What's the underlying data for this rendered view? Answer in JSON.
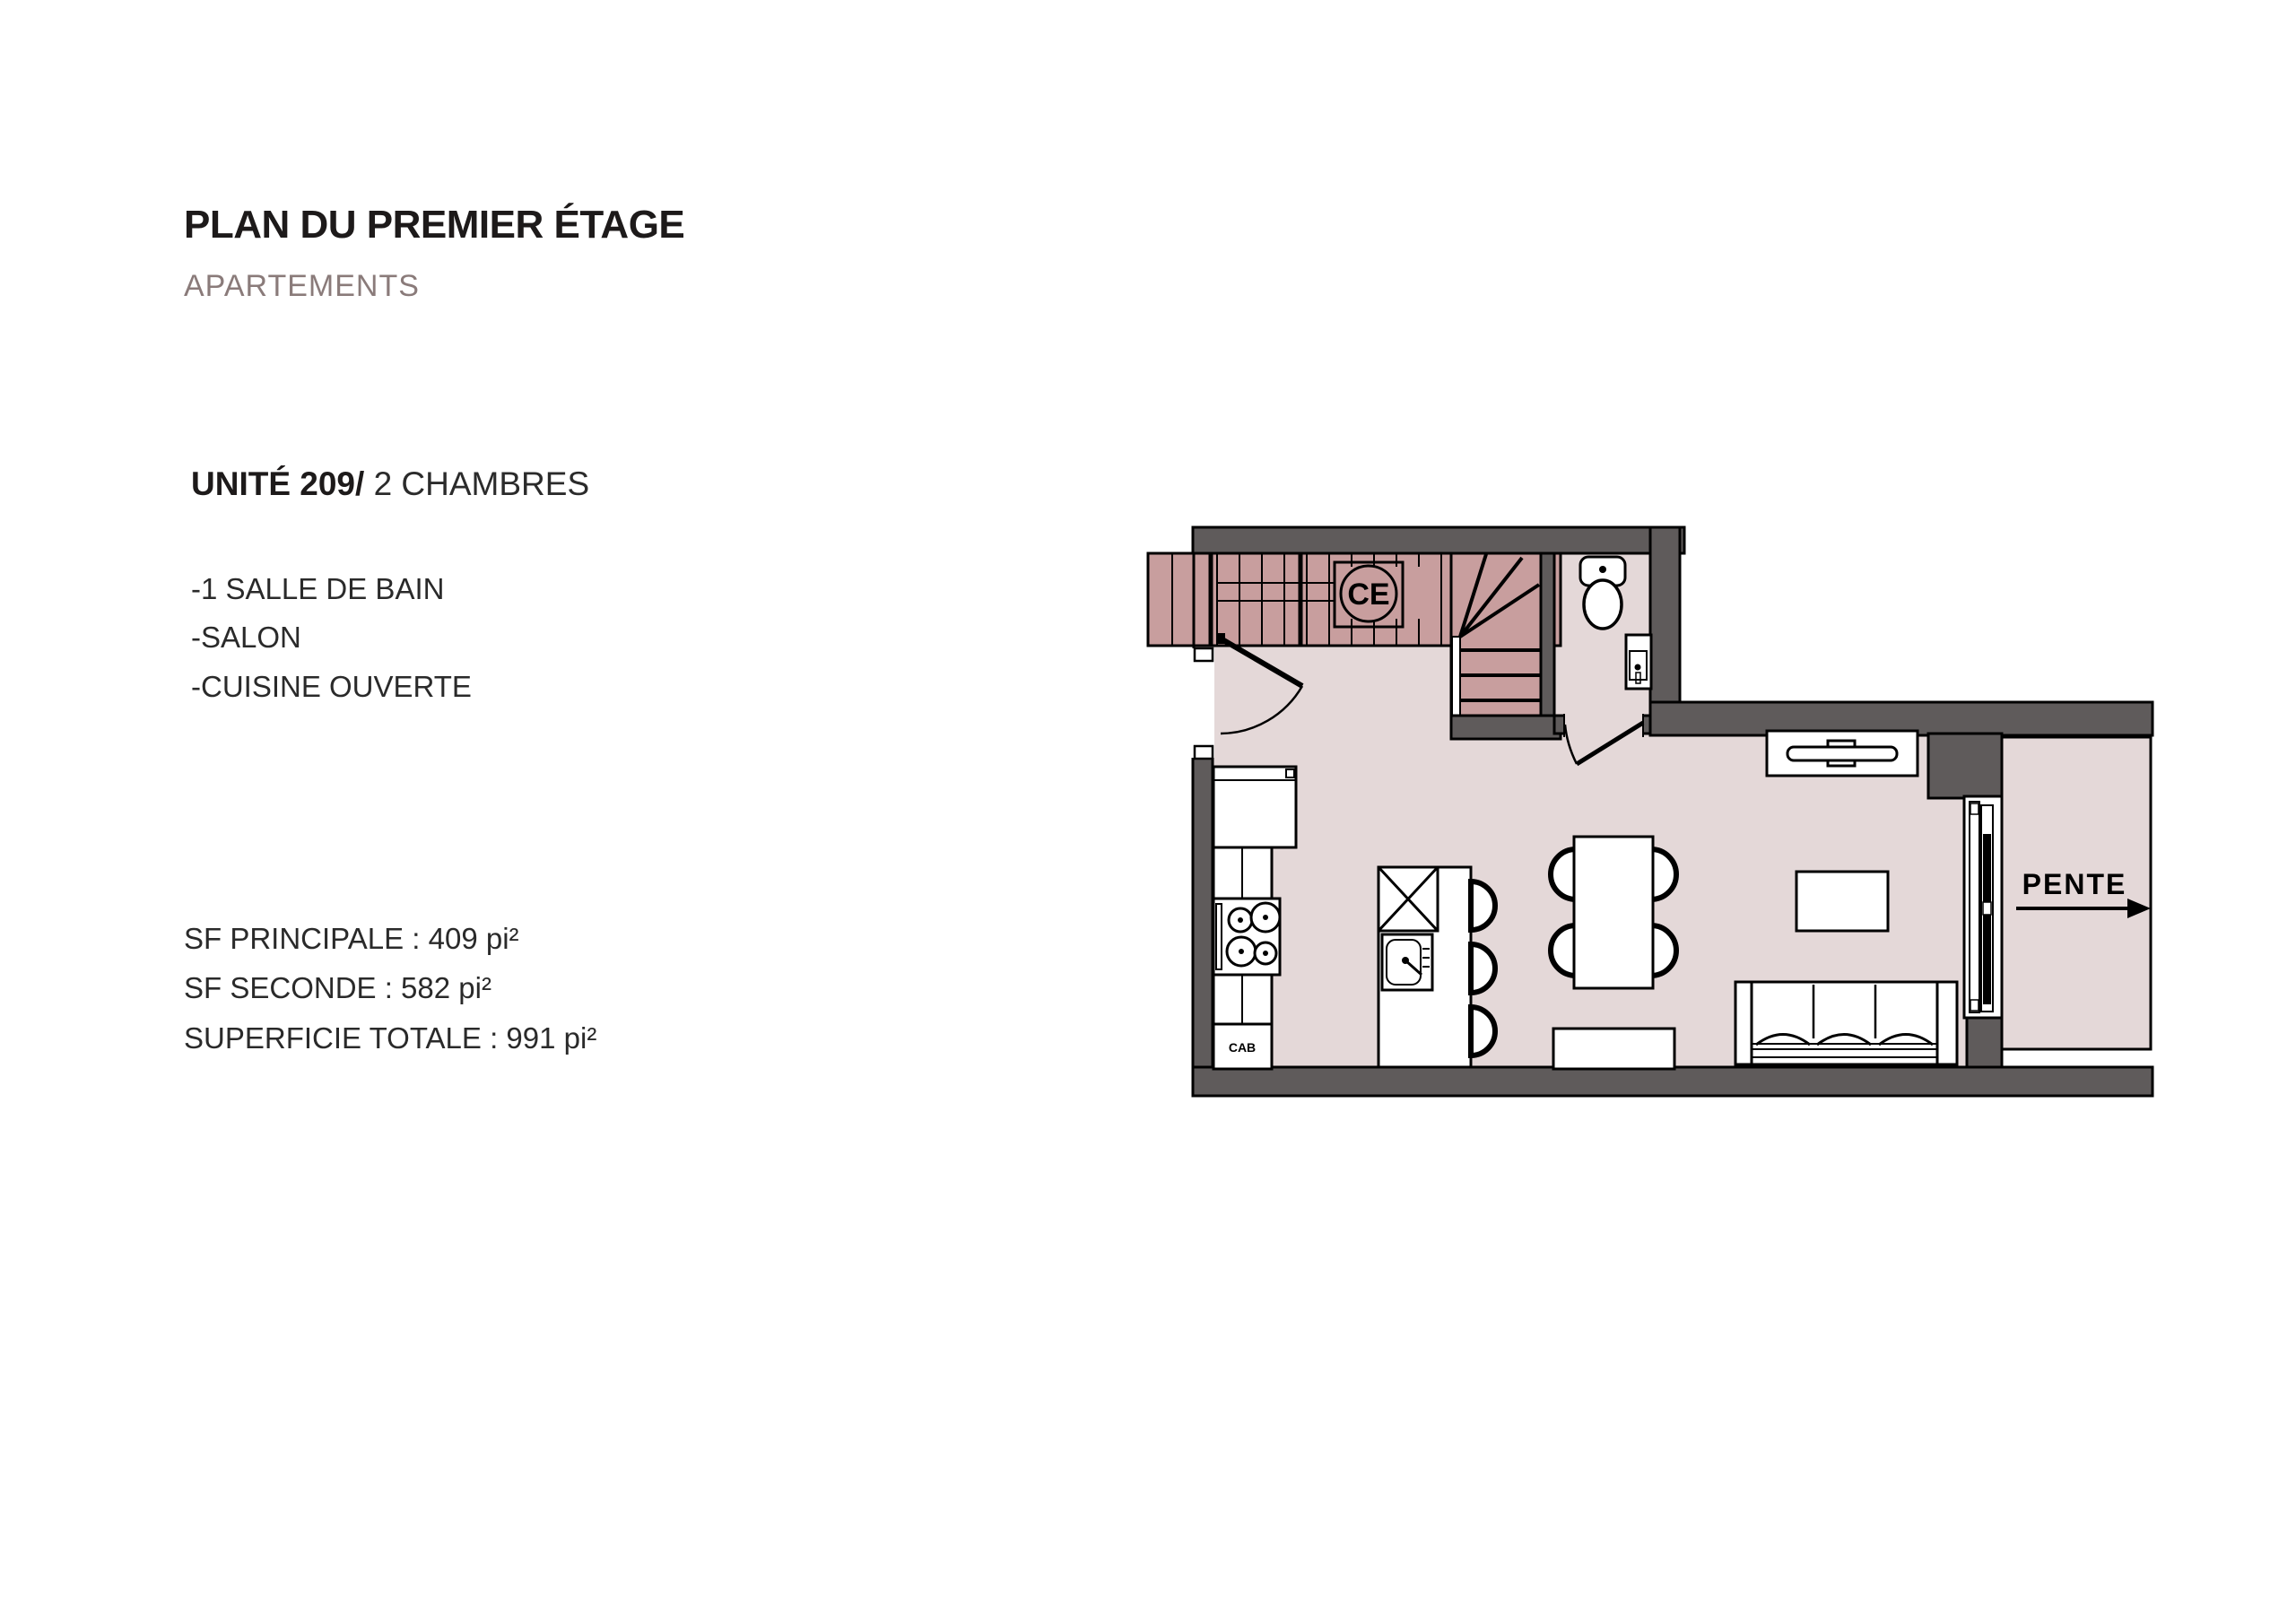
{
  "page": {
    "title": "PLAN DU PREMIER ÉTAGE",
    "subtitle": "APARTEMENTS"
  },
  "unit": {
    "number_label": "UNITÉ 209/",
    "type_label": " 2 CHAMBRES",
    "features": [
      "-1 SALLE DE BAIN",
      "-SALON",
      "-CUISINE OUVERTE"
    ],
    "areas": [
      "SF PRINCIPALE : 409 pi²",
      "SF SECONDE : 582 pi²",
      "SUPERFICIE TOTALE : 991 pi²"
    ]
  },
  "plan": {
    "labels": {
      "water_heater": "CE",
      "cabinet": "CAB",
      "slope": "PENTE"
    },
    "colors": {
      "wall": "#5f5b5b",
      "floor": "#e4d8d8",
      "stairs": "#c89e9e",
      "outline": "#000000",
      "subtitle_text": "#8a7b7a"
    }
  }
}
